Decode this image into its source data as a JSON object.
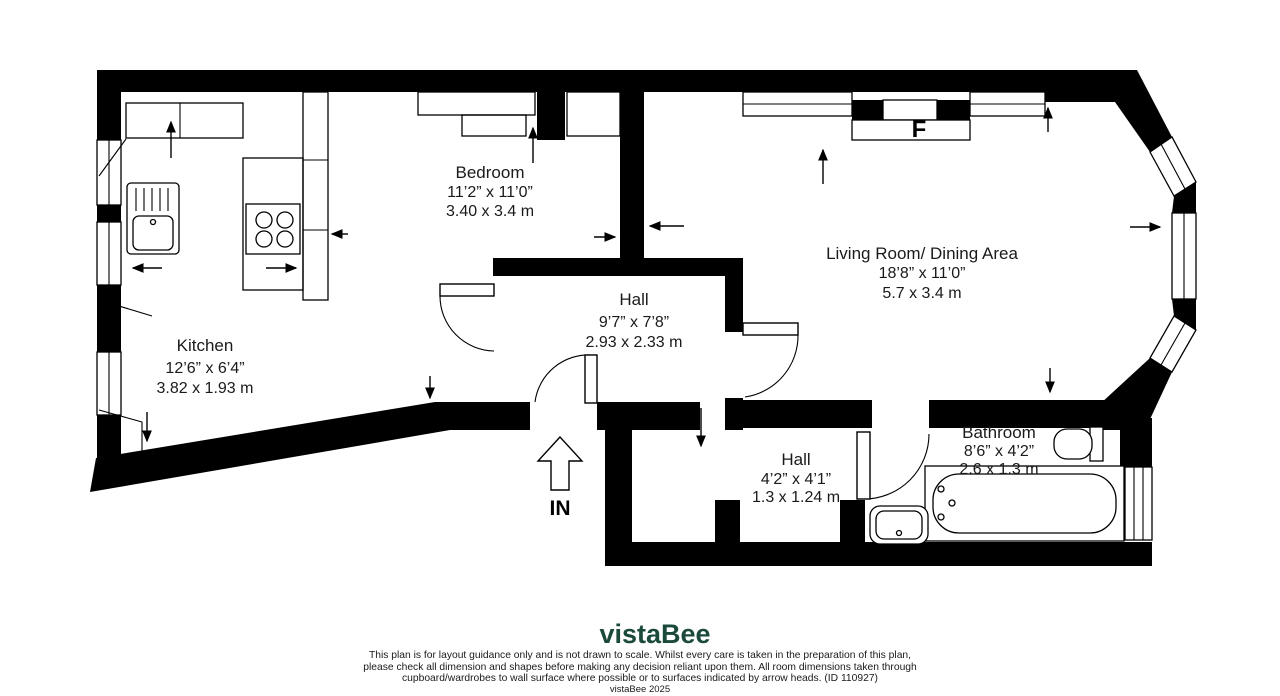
{
  "plan": {
    "wall_color": "#000000",
    "rooms": [
      {
        "name": "Kitchen",
        "imperial": "12’6” x 6’4”",
        "metric": "3.82 x 1.93 m"
      },
      {
        "name": "Bedroom",
        "imperial": "11’2” x 11’0”",
        "metric": "3.40 x 3.4 m"
      },
      {
        "name": "Hall",
        "imperial": "9’7” x 7’8”",
        "metric": "2.93 x 2.33 m"
      },
      {
        "name": "Living Room/ Dining Area",
        "imperial": "18’8” x 11’0”",
        "metric": "5.7 x 3.4 m"
      },
      {
        "name": "Hall",
        "imperial": "4’2” x 4’1”",
        "metric": "1.3 x 1.24 m"
      },
      {
        "name": "Bathroom",
        "imperial": "8’6” x 4’2”",
        "metric": "2.6 x 1.3 m"
      }
    ],
    "markers": {
      "fireplace": "F",
      "entrance": "IN"
    }
  },
  "footer": {
    "logo": "vistaBee",
    "logo_color": "#1B4A3C",
    "lines": [
      "This plan is for layout guidance only and is not drawn to scale. Whilst every care is taken in the preparation of this plan,",
      "please check all dimension and shapes before making any decision reliant upon them. All room dimensions taken through",
      "cupboard/wardrobes to wall surface where possible or to surfaces indicated by arrow heads. (ID 110927)"
    ],
    "copyright": "vistaBee 2025"
  }
}
